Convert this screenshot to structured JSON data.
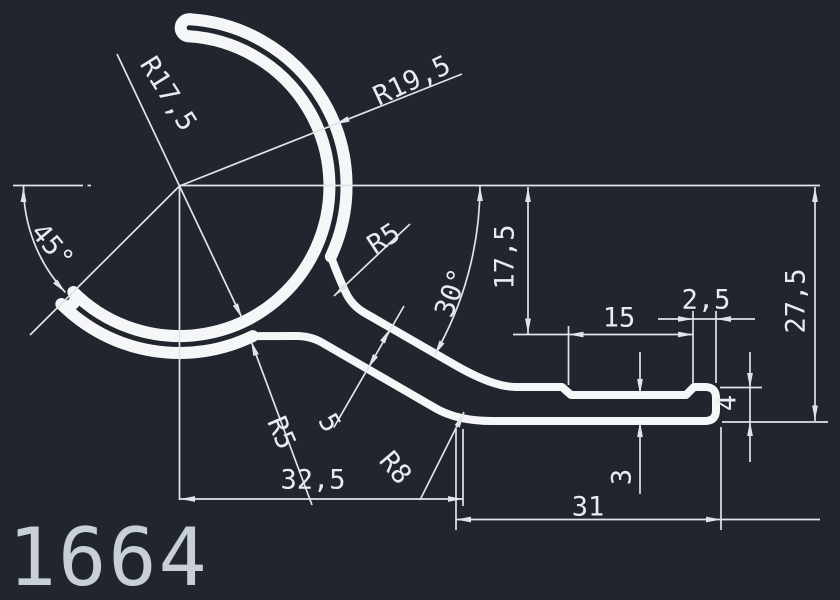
{
  "drawing": {
    "number": "1664",
    "labels": {
      "radius_inner": "R17,5",
      "radius_outer": "R19,5",
      "angle_opening": "45°",
      "radius_neck": "R5",
      "angle_tail": "30°",
      "height_neck": "17,5",
      "groove_width": "15",
      "lip_width": "2,5",
      "height_total": "27,5",
      "lip_height": "4",
      "base_thickness": "3",
      "base_length": "31",
      "tail_offset": "32,5",
      "radius_joint": "R5",
      "tail_thickness": "5",
      "radius_heel": "R8"
    }
  },
  "colors": {
    "bg": "#20252e",
    "profile": "#f4f6f8",
    "dim": "#dfe4ea",
    "text": "#e8ecf1",
    "number": "#c9cfd7"
  }
}
